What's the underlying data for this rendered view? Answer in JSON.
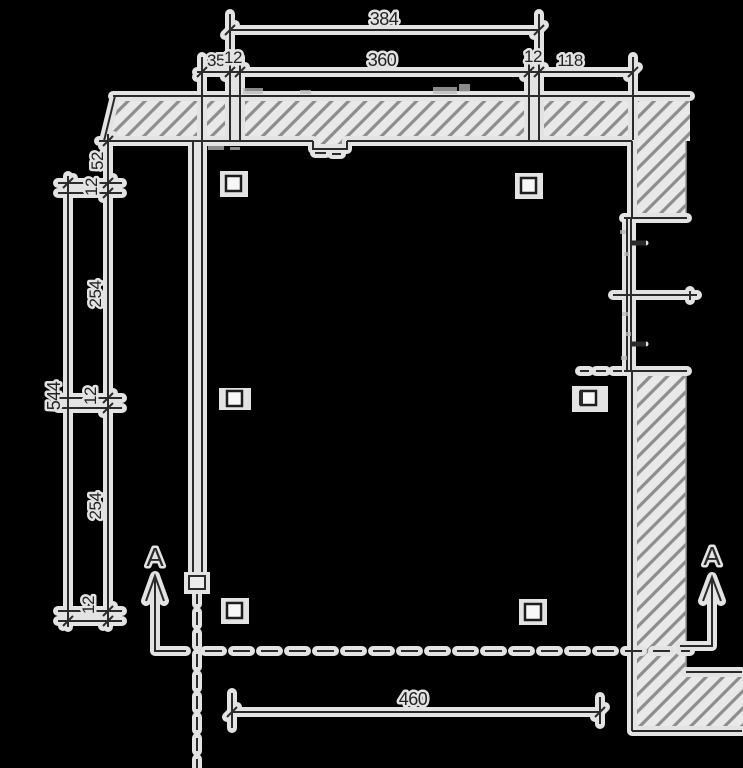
{
  "drawing": {
    "kind": "architectural-floor-plan-scan",
    "colors": {
      "background": "#000000",
      "paper": "#e9e9e9",
      "ink": "#2b2b2b",
      "hatch_line": "#8d8d8d"
    },
    "dimensions": {
      "top_outer_total": "384",
      "top_left_offset": "35",
      "top_col_left": "12",
      "top_inner_span": "360",
      "top_col_right": "12",
      "top_right_extension": "118",
      "left_top_offset": "52",
      "left_col_a": "12",
      "left_span_a": "254",
      "left_col_b": "12",
      "left_span_b": "254",
      "left_col_c": "12",
      "left_outer_total": "544",
      "bottom_span": "460"
    },
    "section_marks": {
      "left_label": "A",
      "right_label": "A"
    }
  }
}
